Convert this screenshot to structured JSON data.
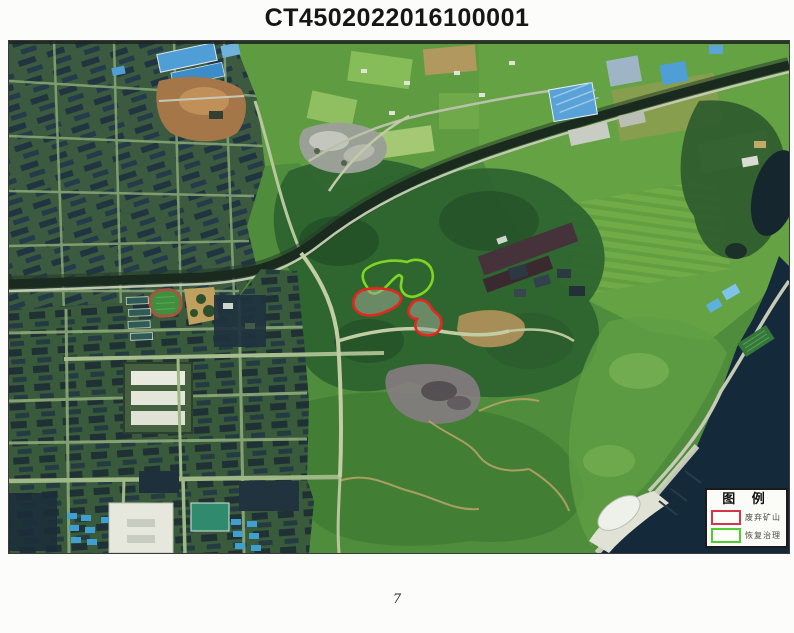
{
  "document": {
    "title": "CT4502022016100001",
    "page_number": "7"
  },
  "figure": {
    "kind": "satellite-imagery-with-mining-annotations",
    "annotations": {
      "abandoned_mine": {
        "label": "废弃矿山",
        "color": "#e6261f",
        "count": 2
      },
      "restoration": {
        "label": "恢复治理",
        "color": "#7fd622",
        "count": 1
      }
    }
  },
  "legend": {
    "title": "图  例",
    "items": [
      {
        "label": "废弃矿山",
        "swatch_color": "#d4354a"
      },
      {
        "label": "恢复治理",
        "swatch_color": "#52cc2e"
      }
    ]
  }
}
